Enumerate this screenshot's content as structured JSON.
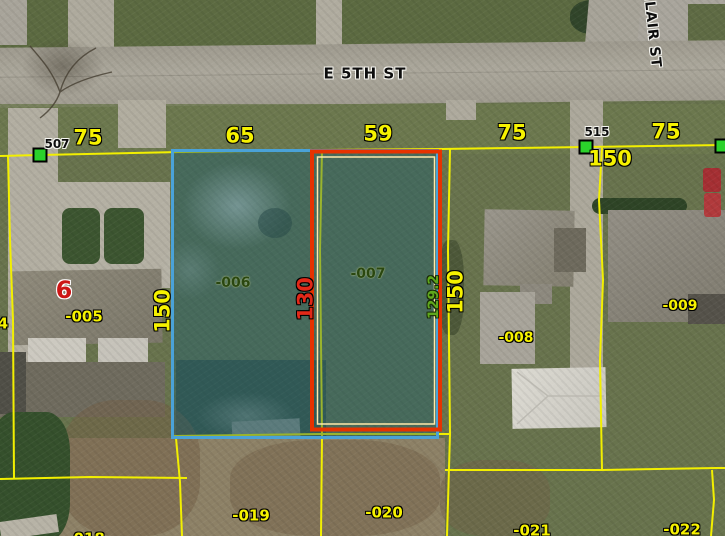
{
  "map": {
    "description": "county GIS parcel viewer over aerial imagery",
    "streets": {
      "e5th": "E 5TH ST",
      "clair": "CLAIR ST"
    },
    "address_points": {
      "p507": "507",
      "p515": "515"
    },
    "frontages": {
      "f1": "75",
      "f2": "65",
      "f3": "59",
      "f4": "75",
      "f5": "75"
    },
    "depths": {
      "d150_left": "150",
      "d150_mid": "150",
      "d150_right": "150",
      "d130": "130",
      "d129_2": "129.2"
    },
    "parcels": {
      "p004": "4",
      "p005": "-005",
      "p006": "-006",
      "p007": "-007",
      "p008": "-008",
      "p009": "-009",
      "p018": "-018",
      "p019": "-019",
      "p020": "-020",
      "p021": "-021",
      "p022": "-022"
    },
    "block": "6",
    "colors": {
      "parcel_line": "#f2ef00",
      "selection_blue": "#4aa2d8",
      "selection_red": "#e63200",
      "selection_red_inner": "#ffe9ab",
      "selection_fill": "rgba(22,92,112,0.40)",
      "marker_green": "#2bd22b",
      "label_yellow": "#f6f200",
      "dim_red": "#e22818",
      "dim_green": "#5fa81c"
    }
  }
}
